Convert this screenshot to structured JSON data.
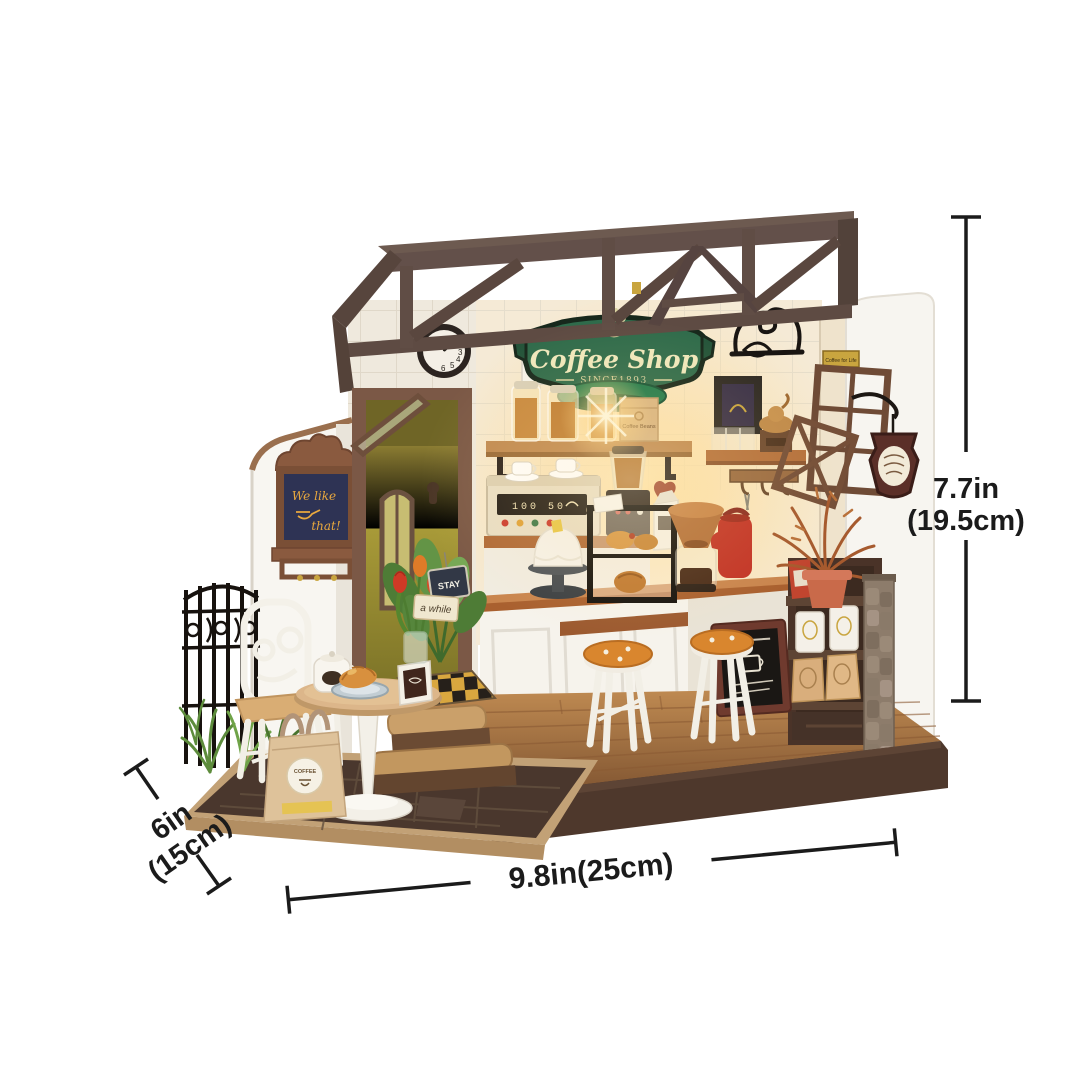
{
  "shop": {
    "sign": {
      "title": "Coffee Shop",
      "subtitle": "SINCE1893"
    },
    "chalkboard": {
      "line1": "We like",
      "line2": "that!"
    },
    "wall_poster": "Ac",
    "side_plaque": "Coffee for Life",
    "door_sign_top": "STAY",
    "door_sign_bottom": "a while",
    "beans_bag": "Coffee Beans",
    "gift_bag": "COFFEE",
    "machine_display": "100 50",
    "clock_numbers": [
      "1",
      "2",
      "3",
      "4",
      "5",
      "6"
    ]
  },
  "dimensions": {
    "height": {
      "line1": "7.7in",
      "line2": "(19.5cm)"
    },
    "width": {
      "label": "9.8in(25cm)"
    },
    "depth": {
      "line1": "6in",
      "line2": "(15cm)"
    }
  },
  "colors": {
    "background": "#ffffff",
    "annotation": "#1b1b1b",
    "roof_brown": "#5e4b43",
    "sign_green": "#2f6b4b",
    "door_olive": "#9a8c33",
    "counter_white": "#f6f3ec",
    "wood_counter": "#a9602f",
    "stool_orange": "#d9862e",
    "base_brown": "#4e382c",
    "iron_black": "#17120e"
  }
}
